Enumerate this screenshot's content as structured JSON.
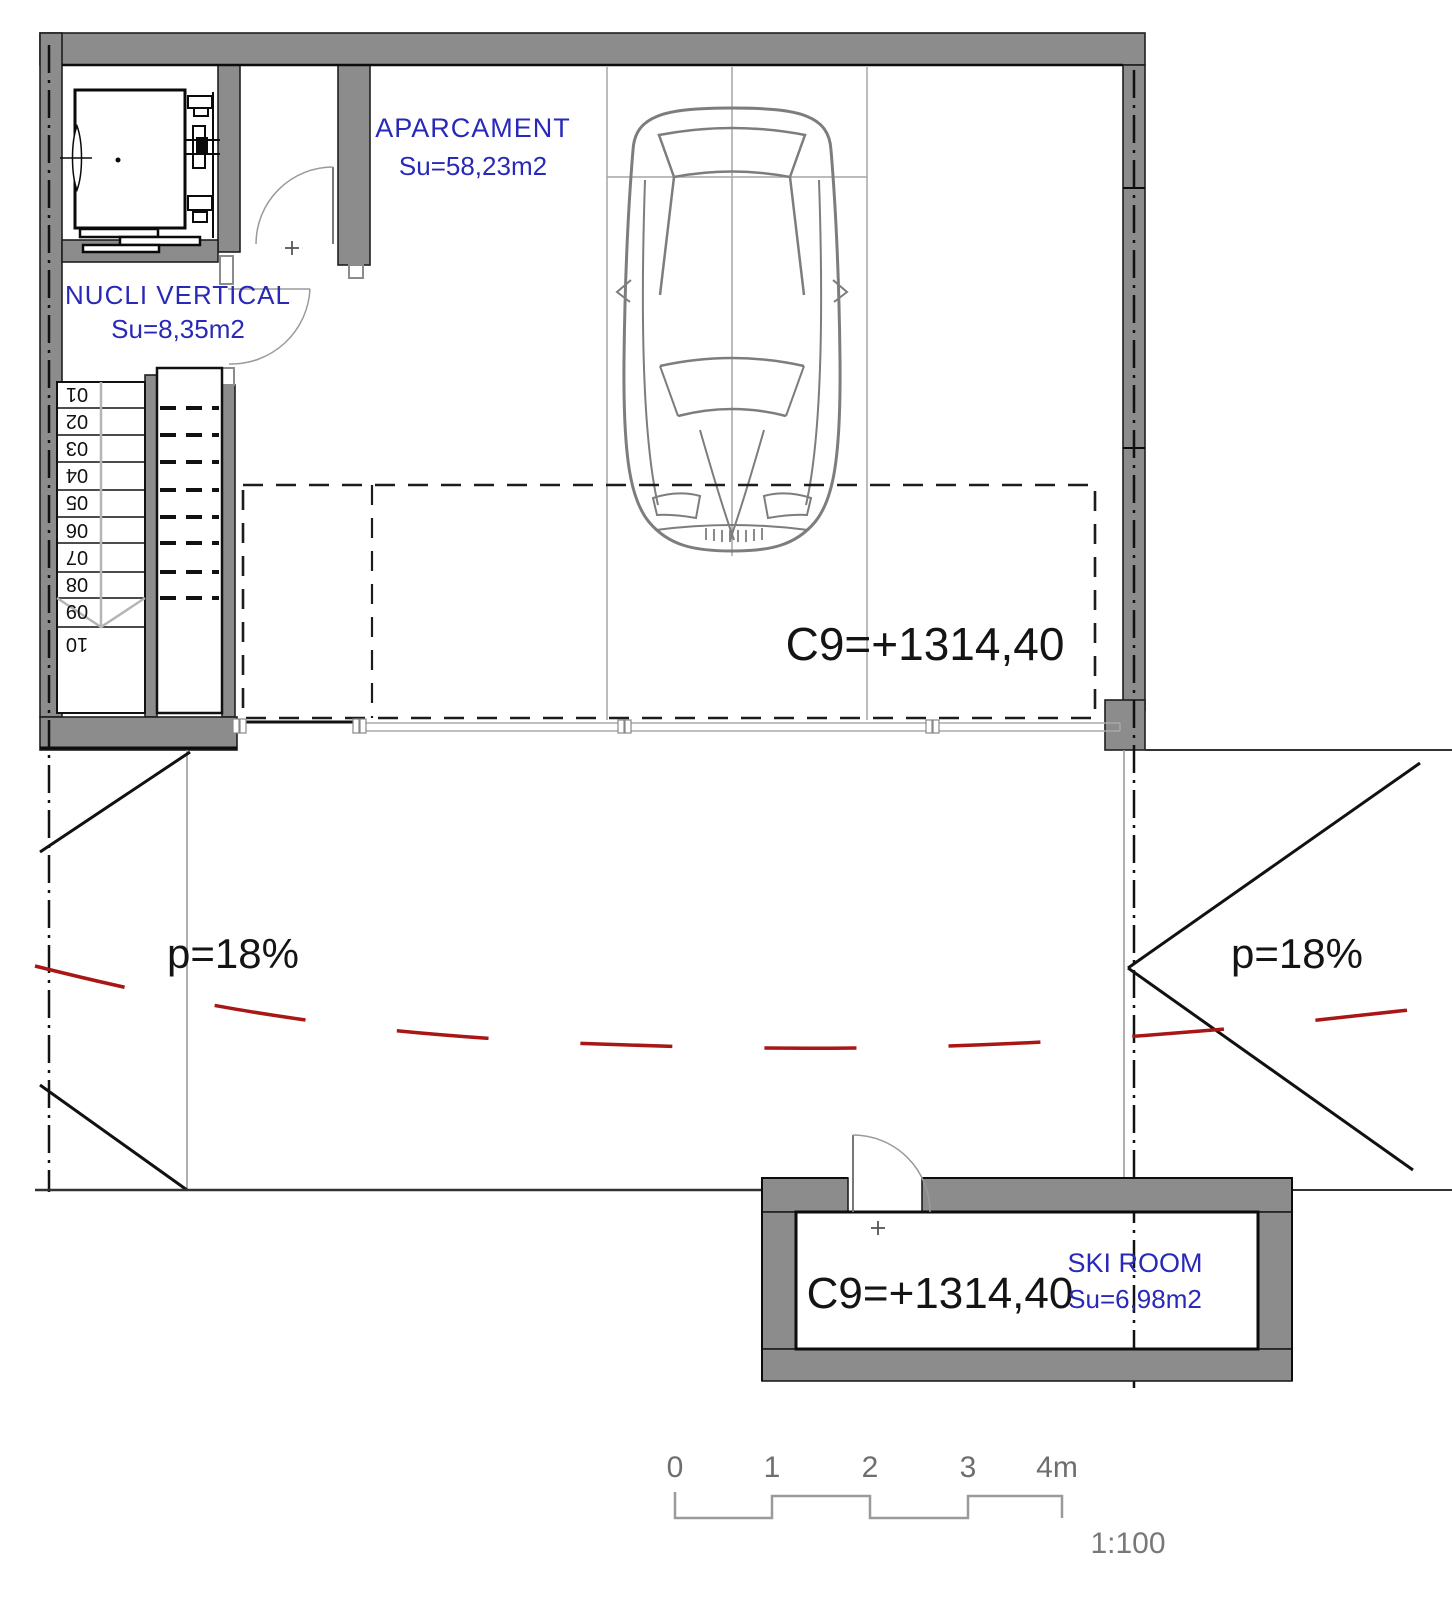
{
  "plan": {
    "title": "Garage level floor plan",
    "rooms": {
      "aparcament": {
        "name": "APARCAMENT",
        "area": "Su=58,23m2"
      },
      "nucli_vertical": {
        "name": "NUCLI VERTICAL",
        "area": "Su=8,35m2"
      },
      "ski_room": {
        "name": "SKI ROOM",
        "area": "Su=6,98m2"
      }
    },
    "levels": {
      "garage": "C9=+1314,40",
      "ski": "C9=+1314,40"
    },
    "slopes": {
      "left": "p=18%",
      "right": "p=18%"
    },
    "stairs": {
      "treads": [
        "01",
        "02",
        "03",
        "04",
        "05",
        "06",
        "07",
        "08",
        "09",
        "10"
      ]
    },
    "scale_bar": {
      "ticks": [
        "0",
        "1",
        "2",
        "3",
        "4m"
      ],
      "ratio": "1:100"
    },
    "colors": {
      "wall_gray": "#8c8c8c",
      "label_blue": "#2829b8",
      "slope_red": "#a81616",
      "line_black": "#141414",
      "line_gray": "#a5a5a5"
    }
  }
}
